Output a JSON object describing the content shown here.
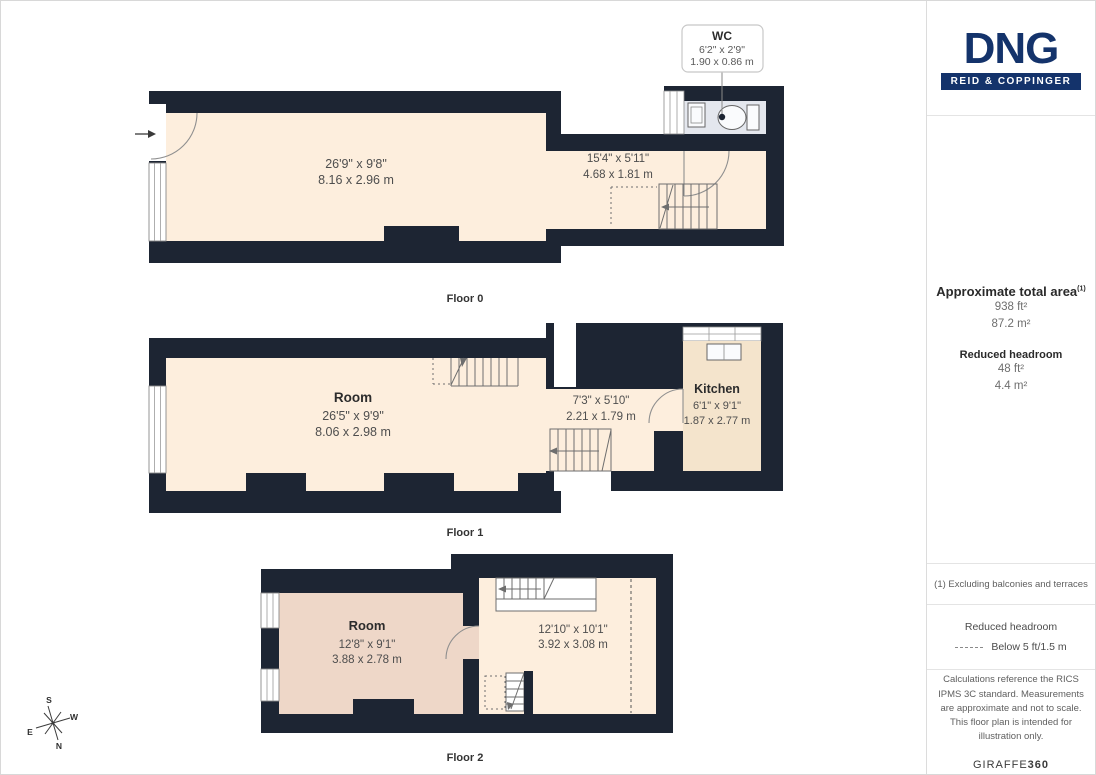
{
  "brand": {
    "name": "DNG",
    "tagline": "REID & COPPINGER"
  },
  "floors": [
    {
      "label": "Floor 0",
      "rooms": [
        {
          "name": "",
          "imperial": "26'9\" x 9'8\"",
          "metric": "8.16 x 2.96 m"
        },
        {
          "name": "",
          "imperial": "15'4\" x 5'11\"",
          "metric": "4.68 x 1.81 m"
        }
      ],
      "callout": {
        "name": "WC",
        "imperial": "6'2\" x 2'9\"",
        "metric": "1.90 x 0.86 m"
      }
    },
    {
      "label": "Floor 1",
      "rooms": [
        {
          "name": "Room",
          "imperial": "26'5\" x 9'9\"",
          "metric": "8.06 x 2.98 m"
        },
        {
          "name": "",
          "imperial": "7'3\" x 5'10\"",
          "metric": "2.21 x 1.79 m"
        },
        {
          "name": "Kitchen",
          "imperial": "6'1\" x 9'1\"",
          "metric": "1.87 x 2.77 m"
        }
      ]
    },
    {
      "label": "Floor 2",
      "rooms": [
        {
          "name": "Room",
          "imperial": "12'8\" x 9'1\"",
          "metric": "3.88 x 2.78 m"
        },
        {
          "name": "",
          "imperial": "12'10\" x 10'1\"",
          "metric": "3.92 x 3.08 m"
        }
      ]
    }
  ],
  "sidebar": {
    "total_area_label": "Approximate total area",
    "total_area_note_ref": "(1)",
    "total_area_ft": "938 ft²",
    "total_area_m": "87.2 m²",
    "reduced_label": "Reduced headroom",
    "reduced_ft": "48 ft²",
    "reduced_m": "4.4 m²",
    "footnote": "(1) Excluding balconies and terraces",
    "legend_title": "Reduced headroom",
    "legend_item": "Below 5 ft/1.5 m",
    "disclaimer": "Calculations reference the RICS IPMS 3C standard. Measurements are approximate and not to scale. This floor plan is intended for illustration only.",
    "provider_name": "GIRAFFE",
    "provider_suffix": "360"
  },
  "compass": {
    "n": "N",
    "s": "S",
    "e": "E",
    "w": "W"
  },
  "colors": {
    "wall": "#1d2533",
    "room": "#fdeedd",
    "room_reduced": "#eed7c8",
    "kitchen": "#f4e4cc",
    "wc": "#e4e7ee",
    "brand_navy": "#14336b"
  }
}
